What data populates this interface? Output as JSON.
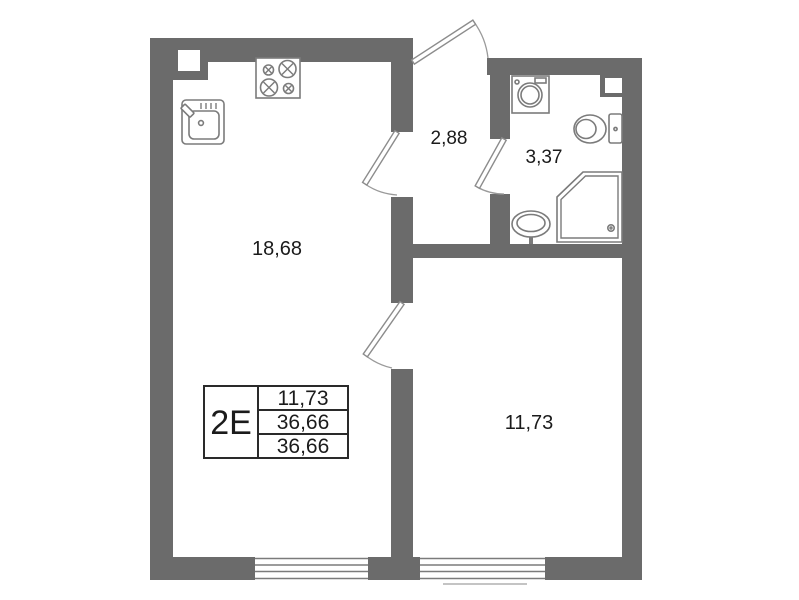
{
  "plan": {
    "rooms": {
      "living_kitchen": {
        "area": "18,68"
      },
      "hallway": {
        "area": "2,88"
      },
      "bathroom": {
        "area": "3,37"
      },
      "bedroom": {
        "area": "11,73"
      }
    },
    "info_table": {
      "unit": "2E",
      "rows": [
        "11,73",
        "36,66",
        "36,66"
      ]
    },
    "fixtures": [
      "stove-icon",
      "kitchen-sink-icon",
      "washing-machine-icon",
      "toilet-icon",
      "shower-icon",
      "pedestal-sink-icon"
    ],
    "colors": {
      "wall": "#6b6b6b",
      "fixture_stroke": "#7b7b7b",
      "door_stroke": "#8c8c8c",
      "text": "#1b1b1b",
      "background": "#ffffff"
    }
  }
}
